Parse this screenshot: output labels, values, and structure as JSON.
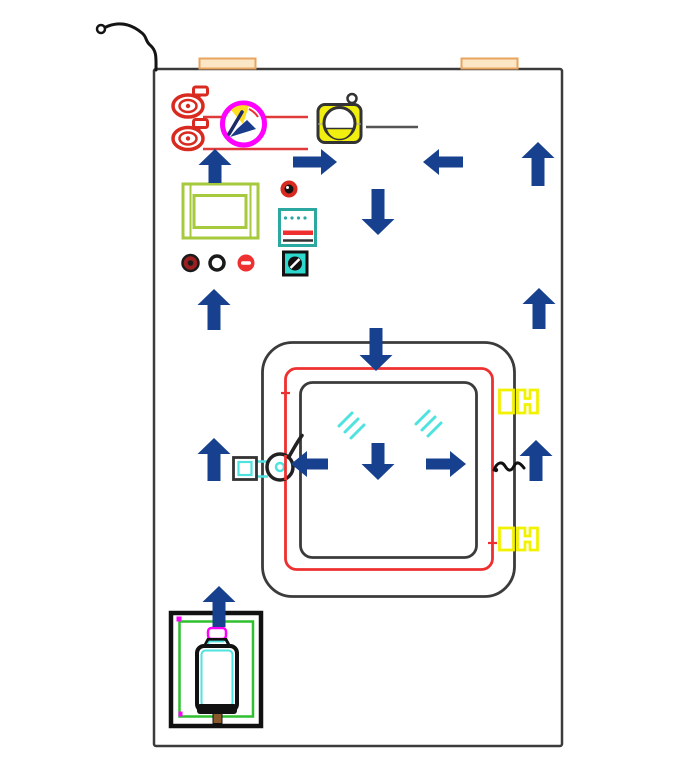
{
  "canvas": {
    "width": 700,
    "height": 771
  },
  "colors": {
    "background": "#ffffff",
    "arrow_navy": "#17418f",
    "outline_dark": "#3b3b3b",
    "valve_red": "#d92a20",
    "door_red": "#ef3030",
    "line_red": "#e03a3a",
    "magenta": "#ff00ff",
    "hinge_yellow": "#f2f200",
    "blower_yellow": "#f0ef0f",
    "hinge_tan_fill": "#fbe7c5",
    "hinge_tan_border": "#e9a45f",
    "frame_green": "#a6c93d",
    "tank_green": "#2fbf2f",
    "glass_cyan": "#4fe3e0",
    "panel_teal": "#2ba8a0",
    "switch_teal": "#2ed8cc",
    "ink_black": "#141414",
    "recorder_navy": "#1a3a8a",
    "recorder_yellow": "#ffdf20",
    "lamp_dark_red": "#9c1f1f",
    "nub_brown": "#8b5a2b",
    "gray_line": "#555555"
  },
  "arrow_geometry": {
    "head_length": 16,
    "vertical": {
      "head_half_width": 16.5,
      "shaft_half_width": 6.5
    },
    "horizontal": {
      "head_half_width": 13,
      "shaft_half_width": 5.5
    }
  },
  "arrows": [
    {
      "dir": "up",
      "cx": 215,
      "tip": 149,
      "len": 34
    },
    {
      "dir": "right",
      "cy": 162,
      "tip": 337,
      "len": 44
    },
    {
      "dir": "left",
      "cy": 162,
      "tip": 423,
      "len": 40
    },
    {
      "dir": "up",
      "cx": 538,
      "tip": 142,
      "len": 44
    },
    {
      "dir": "down",
      "cx": 378,
      "tip": 235,
      "len": 46
    },
    {
      "dir": "up",
      "cx": 214,
      "tip": 289,
      "len": 41
    },
    {
      "dir": "up",
      "cx": 539,
      "tip": 288,
      "len": 41
    },
    {
      "dir": "down",
      "cx": 376,
      "tip": 371,
      "len": 43
    },
    {
      "dir": "up",
      "cx": 214,
      "tip": 438,
      "len": 43
    },
    {
      "dir": "left",
      "cy": 464,
      "tip": 291,
      "len": 37
    },
    {
      "dir": "down",
      "cx": 378,
      "tip": 480,
      "len": 37
    },
    {
      "dir": "right",
      "cy": 464,
      "tip": 466,
      "len": 40
    },
    {
      "dir": "up",
      "cx": 536,
      "tip": 440,
      "len": 41
    },
    {
      "dir": "up",
      "cx": 219,
      "tip": 586,
      "len": 41
    }
  ],
  "components": [
    "cabinet-body",
    "inlet-hose",
    "top-hinge-left",
    "top-hinge-right",
    "solenoid-valve-top",
    "solenoid-valve-bottom",
    "red-pipe-line-1",
    "red-pipe-line-2",
    "chart-recorder-icon",
    "blower-icon",
    "degree-mark",
    "reference-line",
    "control-frame",
    "buzzer-knob",
    "display-panel",
    "indicator-lamp-dark-red",
    "indicator-lamp-white",
    "indicator-lamp-red",
    "key-switch",
    "door-assembly",
    "door-gasket",
    "door-window",
    "glass-hatch-left",
    "glass-hatch-right",
    "door-hinge-top",
    "door-hinge-bottom",
    "door-latch-left",
    "door-latch-right",
    "generator-box",
    "water-bottle",
    "flow-arrow-layer"
  ]
}
